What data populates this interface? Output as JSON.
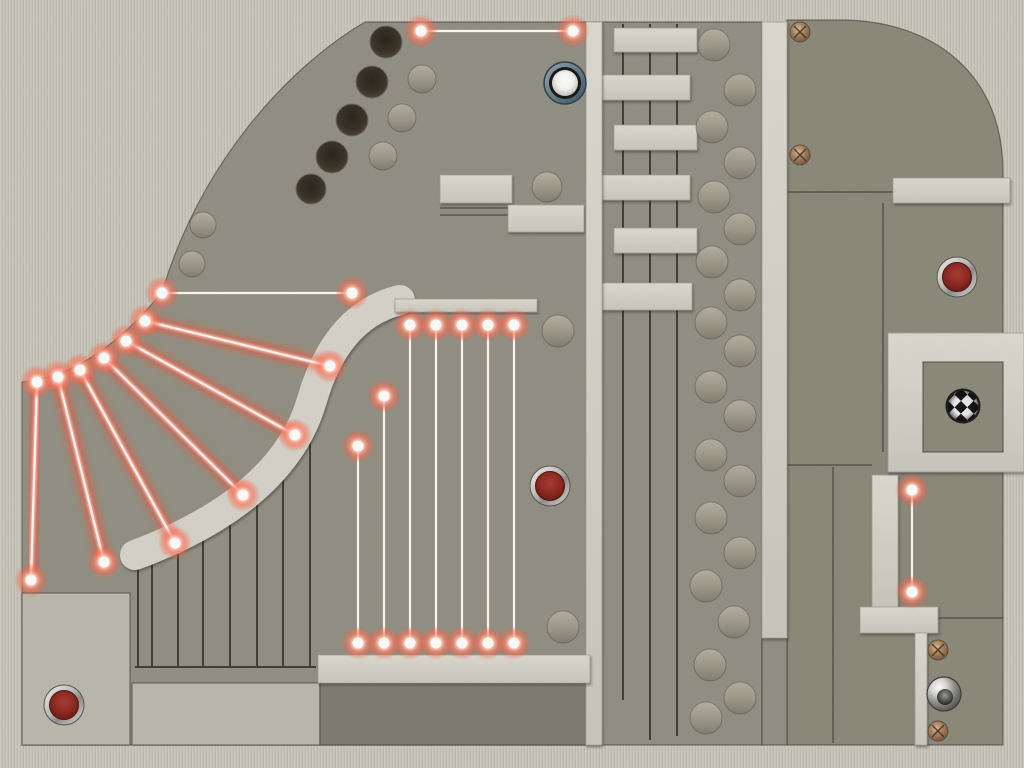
{
  "board": {
    "width": 1024,
    "height": 768,
    "colors": {
      "bg": "#c7c4b9",
      "floorDark": "#908e81",
      "floorRight": "#898778",
      "floorRecess": "#7c7a6e",
      "floorLight": "#bab7ac",
      "wall": "#d5d3c9",
      "groove": "#3c3a31",
      "seam": "#55534a",
      "laser_core": "#fff7f3",
      "laser_mid": "#ffb3a6",
      "laser_glow": "#ff4a2e",
      "button_red": "#8c241d",
      "ball_ring": "#46606c",
      "goal_dark": "#101010",
      "goal_light": "#f2f2f2",
      "screw_bronze": "#a9805c"
    },
    "floors": [
      {
        "path": "M365,22 L762,22 L762,745 L22,745 L22,382 Q95,375 162,292 C205,150 300,60 365,22 Z",
        "fill": "floorDark"
      },
      {
        "path": "M787,20 L845,20 C935,22 1003,75 1003,172 L1003,745 L787,745 Z",
        "fill": "floorRight"
      },
      {
        "path": "M22,593 h108 v152 h-108 Z",
        "fill": "floorLight"
      },
      {
        "path": "M132,683 h188 v62 h-188 Z",
        "fill": "floorLight"
      },
      {
        "path": "M320,683 h268 v62 h-268 Z",
        "fill": "floorRecess"
      },
      {
        "path": "M762,638 h25 v107 h-25 Z",
        "fill": "floorDark"
      }
    ],
    "bands": [
      {
        "path": "M400,300 C350,312 325,355 312,400 C296,455 250,512 135,555",
        "width": 30
      }
    ],
    "walls": [
      [
        440,
        175,
        72,
        28
      ],
      [
        508,
        205,
        76,
        27
      ],
      [
        614,
        28,
        83,
        24
      ],
      [
        602,
        75,
        88,
        25
      ],
      [
        614,
        125,
        83,
        25
      ],
      [
        602,
        175,
        88,
        25
      ],
      [
        614,
        228,
        83,
        25
      ],
      [
        602,
        283,
        90,
        27
      ],
      [
        586,
        22,
        16,
        723
      ],
      [
        395,
        299,
        142,
        13
      ],
      [
        318,
        655,
        272,
        28
      ],
      [
        762,
        22,
        25,
        616
      ],
      [
        893,
        178,
        117,
        25
      ],
      [
        872,
        475,
        26,
        132
      ],
      [
        860,
        607,
        78,
        26
      ],
      [
        915,
        633,
        12,
        112
      ]
    ],
    "goal_surround": [
      888,
      333,
      136,
      139
    ],
    "insets": [
      {
        "rect": [
          923,
          362,
          80,
          90
        ],
        "fill": "floorRight"
      }
    ],
    "grooves": [
      [
        623,
        24,
        623,
        700
      ],
      [
        650,
        24,
        650,
        740
      ],
      [
        677,
        24,
        677,
        736
      ],
      [
        138,
        558,
        138,
        667
      ],
      [
        152,
        552,
        152,
        667
      ],
      [
        178,
        545,
        178,
        667
      ],
      [
        203,
        532,
        203,
        667
      ],
      [
        230,
        512,
        230,
        667
      ],
      [
        257,
        485,
        257,
        667
      ],
      [
        283,
        450,
        283,
        667
      ],
      [
        310,
        415,
        310,
        667
      ],
      [
        135,
        667,
        316,
        667
      ]
    ],
    "seams": [
      [
        440,
        208,
        508,
        208
      ],
      [
        440,
        215,
        508,
        215
      ],
      [
        787,
        192,
        893,
        192
      ],
      [
        883,
        203,
        883,
        452
      ],
      [
        787,
        465,
        872,
        465
      ],
      [
        833,
        467,
        833,
        743
      ],
      [
        927,
        618,
        1003,
        618
      ]
    ],
    "lasers": [
      [
        162,
        293,
        352,
        293
      ],
      [
        145,
        321,
        330,
        366
      ],
      [
        126,
        341,
        295,
        435
      ],
      [
        104,
        358,
        243,
        495
      ],
      [
        80,
        370,
        175,
        543
      ],
      [
        58,
        377,
        104,
        562
      ],
      [
        37,
        382,
        31,
        580
      ],
      [
        421,
        31,
        573,
        31
      ],
      [
        358,
        446,
        358,
        643
      ],
      [
        384,
        396,
        384,
        643
      ],
      [
        410,
        325,
        410,
        643
      ],
      [
        436,
        325,
        436,
        643
      ],
      [
        462,
        325,
        462,
        643
      ],
      [
        488,
        325,
        488,
        643
      ],
      [
        514,
        325,
        514,
        643
      ],
      [
        912,
        490,
        912,
        592
      ]
    ],
    "holes": [
      [
        386,
        42,
        16
      ],
      [
        372,
        82,
        16
      ],
      [
        352,
        120,
        16
      ],
      [
        332,
        157,
        16
      ],
      [
        311,
        189,
        15
      ]
    ],
    "bumps": [
      [
        422,
        79,
        14
      ],
      [
        402,
        118,
        14
      ],
      [
        383,
        156,
        14
      ],
      [
        203,
        225,
        13
      ],
      [
        192,
        264,
        13
      ],
      [
        547,
        187,
        15
      ],
      [
        558,
        331,
        16
      ],
      [
        563,
        627,
        16
      ],
      [
        714,
        45,
        16
      ],
      [
        740,
        90,
        16
      ],
      [
        712,
        127,
        16
      ],
      [
        740,
        163,
        16
      ],
      [
        714,
        197,
        16
      ],
      [
        740,
        229,
        16
      ],
      [
        712,
        262,
        16
      ],
      [
        740,
        295,
        16
      ],
      [
        711,
        323,
        16
      ],
      [
        740,
        351,
        16
      ],
      [
        711,
        387,
        16
      ],
      [
        740,
        416,
        16
      ],
      [
        711,
        455,
        16
      ],
      [
        740,
        481,
        16
      ],
      [
        711,
        518,
        16
      ],
      [
        740,
        553,
        16
      ],
      [
        706,
        586,
        16
      ],
      [
        734,
        622,
        16
      ],
      [
        710,
        665,
        16
      ],
      [
        740,
        698,
        16
      ],
      [
        706,
        718,
        16
      ]
    ],
    "screws": [
      [
        800,
        32,
        10
      ],
      [
        800,
        155,
        10
      ],
      [
        938,
        650,
        10
      ],
      [
        938,
        731,
        10
      ]
    ],
    "buttons": [
      [
        550,
        486,
        19
      ],
      [
        957,
        277,
        19
      ],
      [
        64,
        705,
        19
      ]
    ],
    "ball": [
      565,
      83,
      20
    ],
    "goal": [
      963,
      406,
      16
    ],
    "dome": [
      944,
      694,
      17
    ]
  }
}
